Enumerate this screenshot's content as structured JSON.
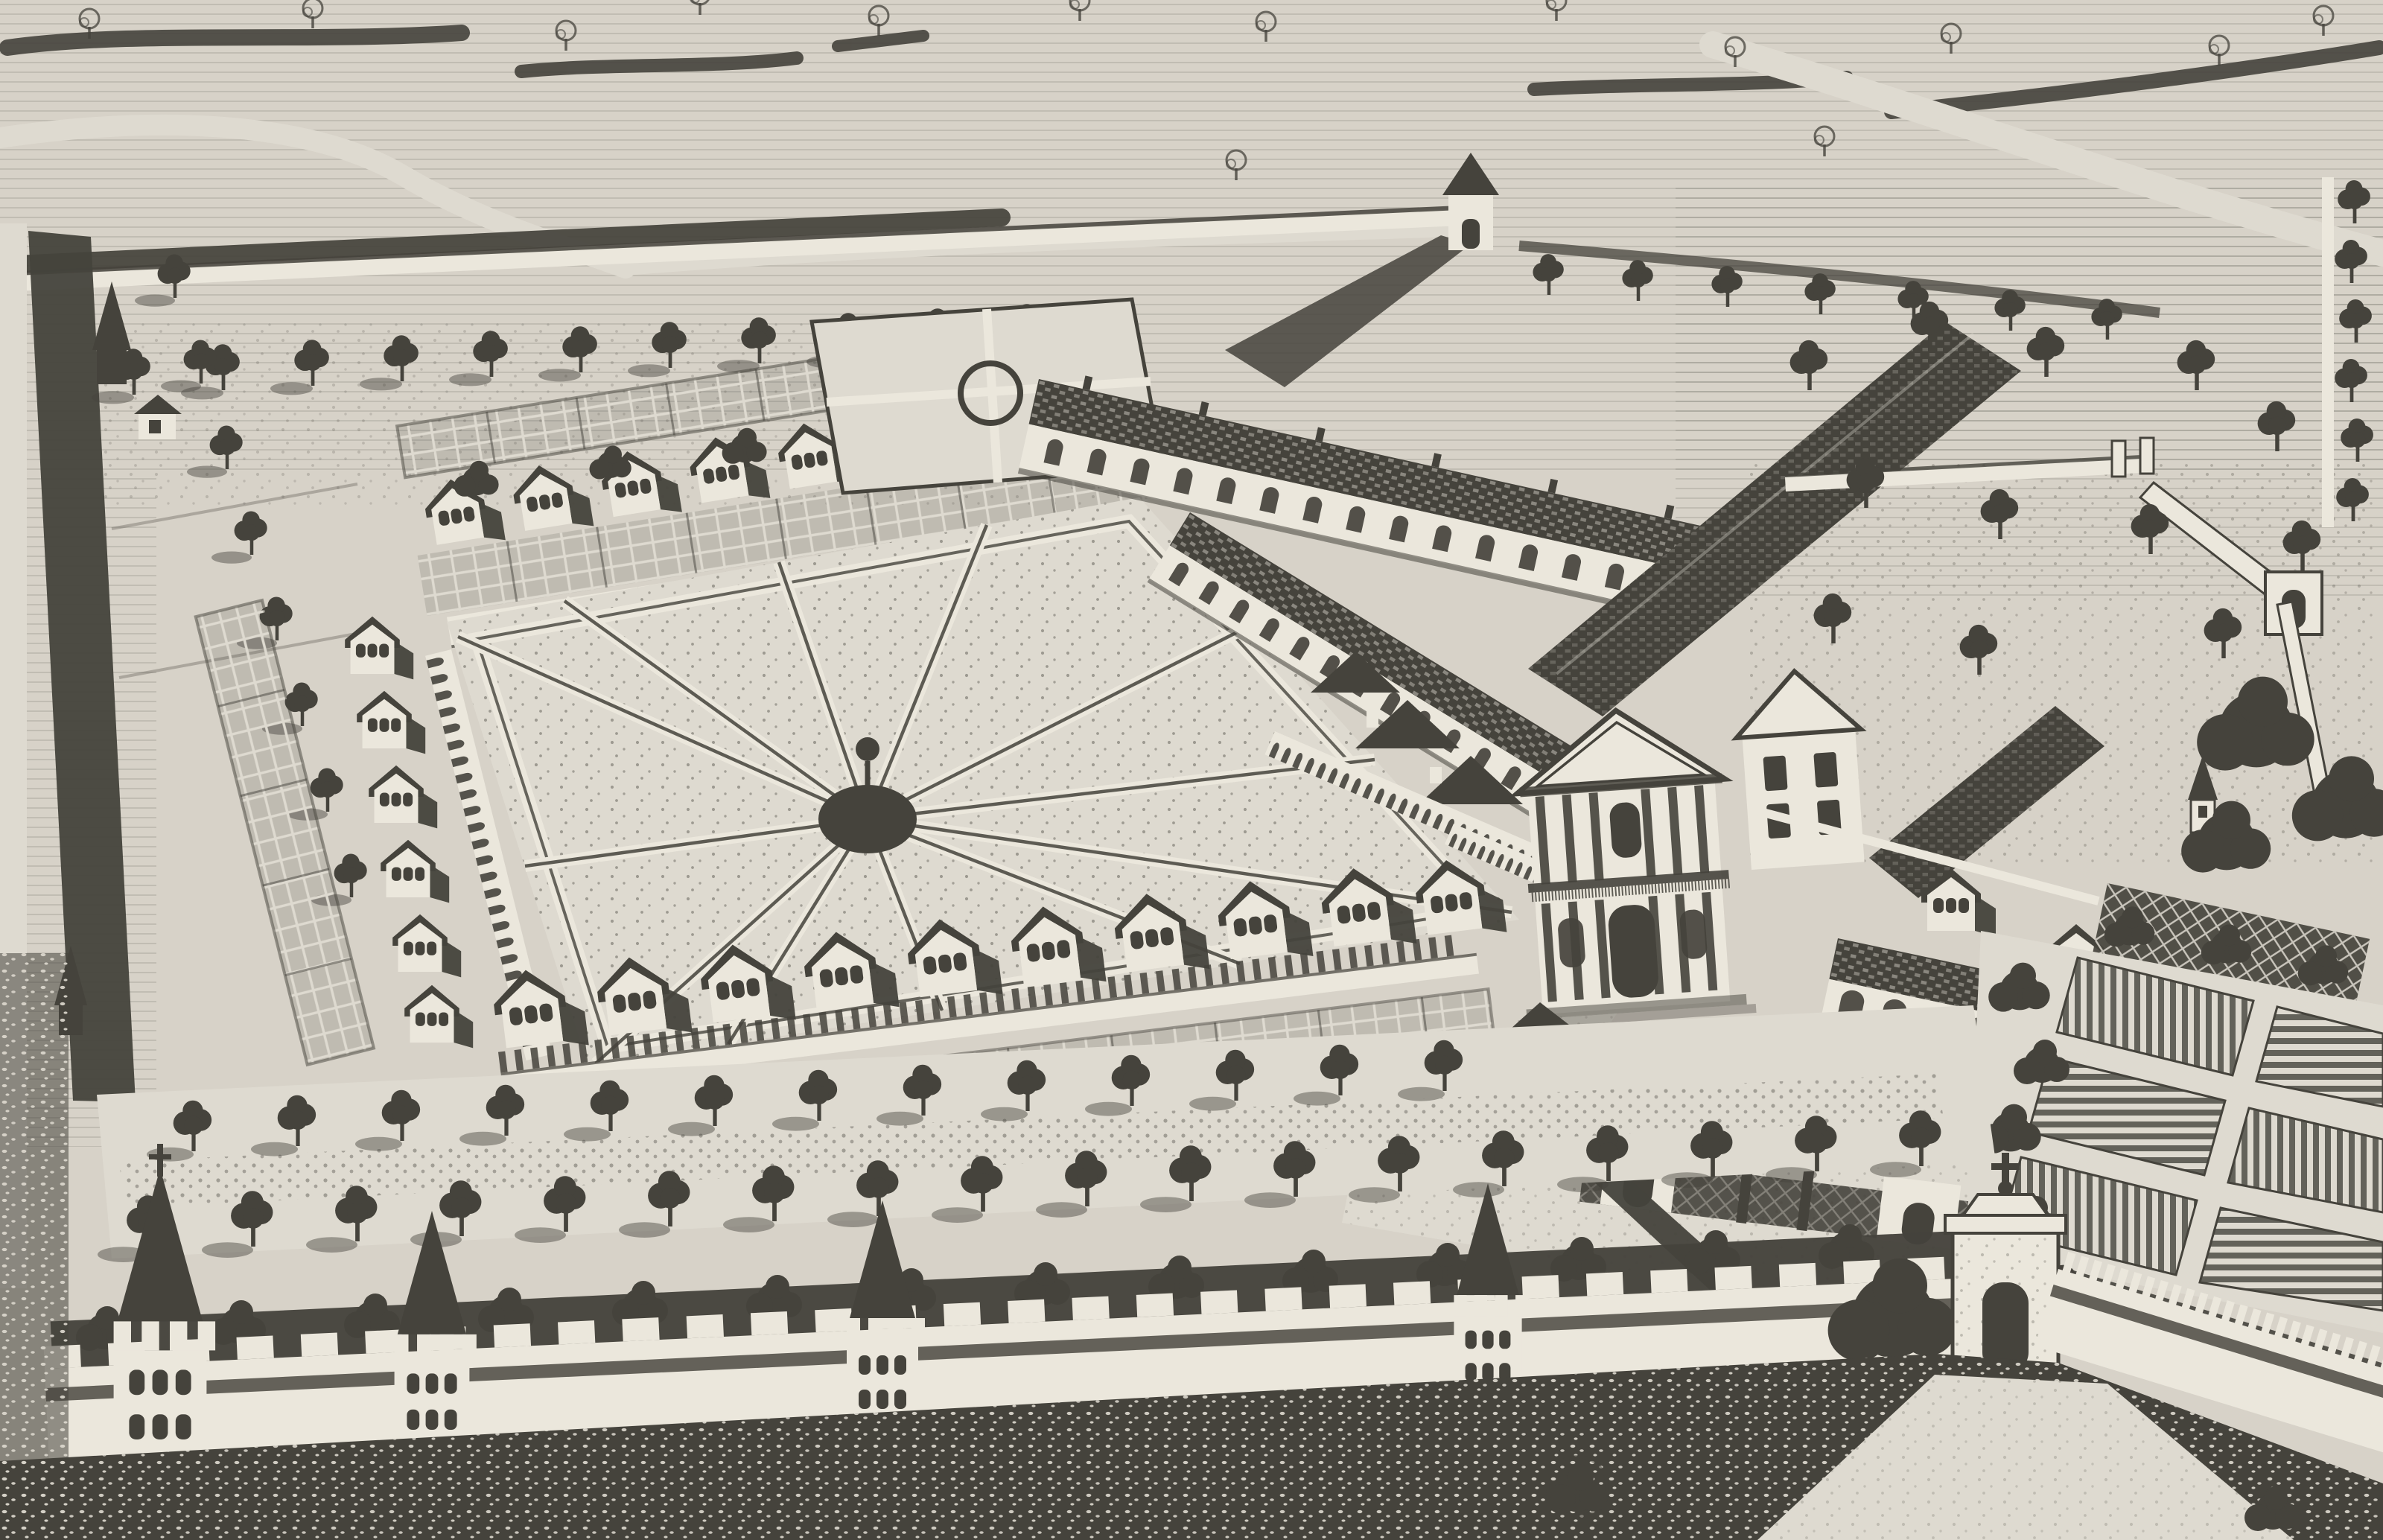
{
  "artwork": {
    "kind": "black-and-white engraving photograph",
    "subject": "bird's-eye view of a walled charterhouse monastery estate",
    "visible_text": [],
    "elements": {
      "great_cloister": "large quadrilateral garden with radiating walks from a central mound planted with a single tree",
      "cells": "rows of small gabled monk cells, each with a latticed walled garden, on the north, west and south sides of the cloister",
      "arcade": "arched cloister gallery bordering the garden on two sides",
      "church": "two-storey classical facade with triangular pediment, column bays, balustrade and arched portal; long tiled nave roof behind",
      "outbuildings": "long tiled-roof ranges with rows of windows and arched galleries between cloister and church",
      "precinct_wall": "crenellated white enclosure wall with square spired watch towers and an arched gatehouse crowned by a cross",
      "north_gate": "small pyramidal-roofed gate in the upper boundary wall casting a long shadow",
      "kitchen_garden": "six striped planting beds separated by light paths in the south-east corner",
      "orchard": "walled orchard with scattered round trees and corner arch gate on the east side",
      "avenues": "double row of round trees with cast shadows inside the south wall; tree rows along the west and north approaches",
      "surroundings": "hatched open fields, hedgerows, winding light roads and dark stippled meadows outside the walls"
    }
  },
  "counts": {
    "radial_garden_walks": 12,
    "south_wall_towers": 4,
    "gatehouses": 3,
    "kitchen_garden_beds": 6,
    "cloister_cells_drawn": 26,
    "avenue_trees_rows": 2
  },
  "palette": {
    "paper": "#d7d2c8",
    "paper2": "#dedad0",
    "wall": "#ebe7dc",
    "ink": "#45433c",
    "ink2": "#56544c",
    "soft": "#6e6b62"
  }
}
